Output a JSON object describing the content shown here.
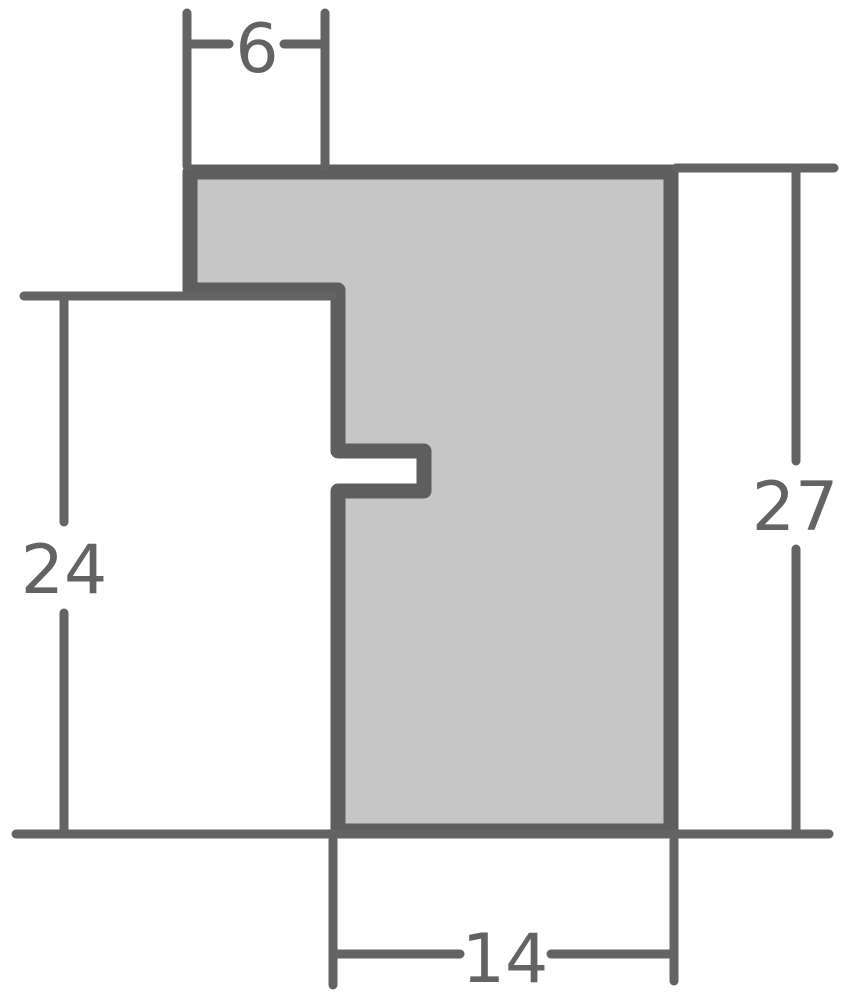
{
  "diagram": {
    "kind": "frame-moulding-profile-cross-section",
    "dimensions": {
      "top_width": {
        "label": "6"
      },
      "left_height": {
        "label": "24"
      },
      "right_height": {
        "label": "27"
      },
      "bottom_width": {
        "label": "14"
      }
    },
    "colors": {
      "background": "#ffffff",
      "profile_fill": "#c6c6c6",
      "profile_outline": "#5e5e5e",
      "dimension_lines": "#636363",
      "dimension_text": "#636363"
    }
  }
}
